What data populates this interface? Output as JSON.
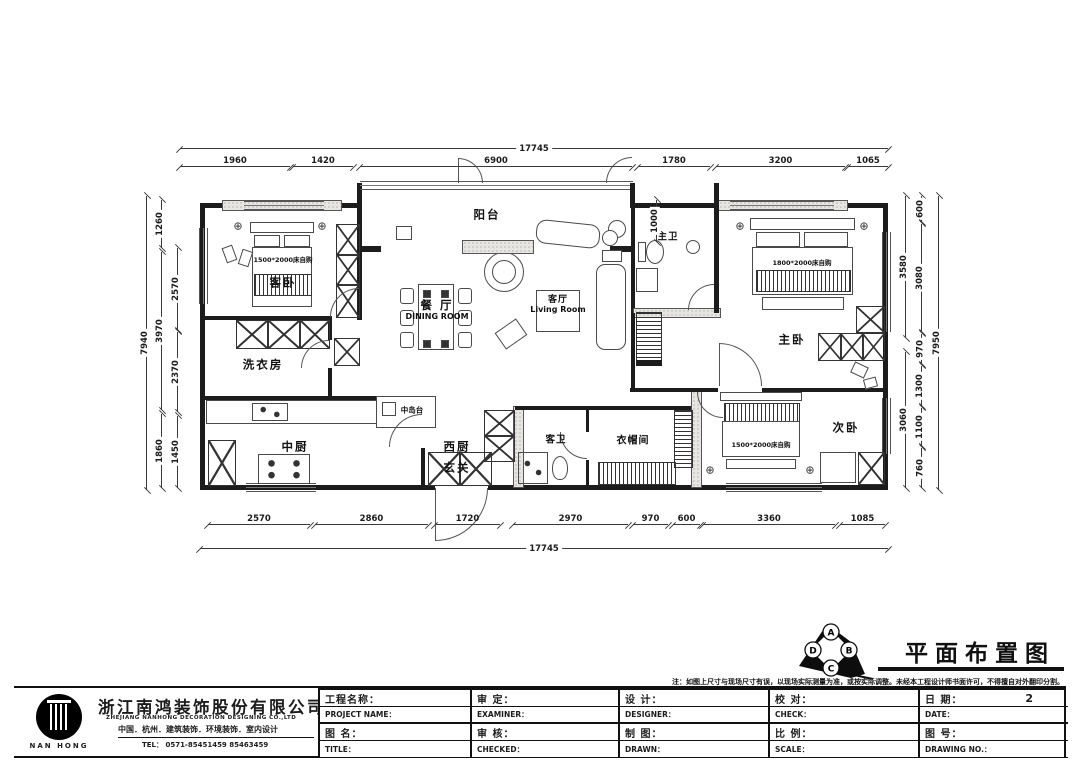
{
  "drawing": {
    "title": "平面布置图",
    "note": "注：如图上尺寸与现场尺寸有误，以现场实际测量为准，或按实际调整。未经本工程设计师书面许可，不得擅自对外翻印分割。",
    "elevation_letters": {
      "a": "A",
      "b": "B",
      "c": "C",
      "d": "D"
    }
  },
  "rooms": {
    "balcony": "阳台",
    "guest_bedroom": "客卧",
    "dining_cn": "餐 厅",
    "dining_en": "DINING ROOM",
    "living_cn": "客厅",
    "living_en": "Living Room",
    "master_bath": "主卫",
    "master_bedroom": "主卧",
    "laundry": "洗衣房",
    "chinese_kitchen": "中厨",
    "western_kitchen": "西厨",
    "island": "中岛台",
    "foyer": "玄关",
    "guest_bath": "客卫",
    "cloakroom": "衣帽间",
    "second_bedroom": "次卧"
  },
  "furniture": {
    "guest_bed": "1500*2000床自购",
    "master_bed": "1800*2000床自购",
    "second_bed": "1500*2000床自购"
  },
  "dims": {
    "top_total": "17745",
    "top": [
      "1960",
      "1420",
      "6900",
      "1780",
      "3200",
      "1065"
    ],
    "bottom": [
      "2570",
      "2860",
      "1720",
      "2970",
      "970",
      "600",
      "3360",
      "1085"
    ],
    "bottom_total": "17745",
    "left_total": "7940",
    "left_mid": [
      "1260",
      "3970",
      "1860"
    ],
    "left_inner": [
      "2570",
      "2370",
      "1450"
    ],
    "right_total": "7950",
    "right_mid": [
      "3580",
      "3060"
    ],
    "right_inner": [
      "600",
      "3080",
      "970",
      "1300",
      "1100",
      "760"
    ],
    "interior_1000": "1000"
  },
  "company": {
    "name_cn": "浙江南鸿装饰股份有限公司",
    "name_en": "ZHEJIANG NANHONG DECORATION DESIGNING CO.,LTD",
    "services": "中国．杭州．建筑装饰．环境装饰．室内设计",
    "tel": "TEL： 0571-85451459  85463459",
    "logo": "NAN HONG"
  },
  "titleblock": {
    "project_cn": "工程名称：",
    "project_en": "PROJECT NAME：",
    "title_cn": "图 名：",
    "title_en": "TITLE：",
    "examiner_cn": "审  定：",
    "examiner_en": "EXAMINER：",
    "checked_cn": "审  核：",
    "checked_en": "CHECKED：",
    "designer_cn": "设  计：",
    "designer_en": "DESIGNER：",
    "drawn_cn": "制  图：",
    "drawn_en": "DRAWN：",
    "check_cn": "校  对：",
    "check_en": "CHECK：",
    "scale_cn": "比  例：",
    "scale_en": "SCALE：",
    "date_cn": "日  期：",
    "date_value": "2",
    "date_en": "DATE：",
    "no_cn": "图  号：",
    "no_en": "DRAWING NO.："
  }
}
